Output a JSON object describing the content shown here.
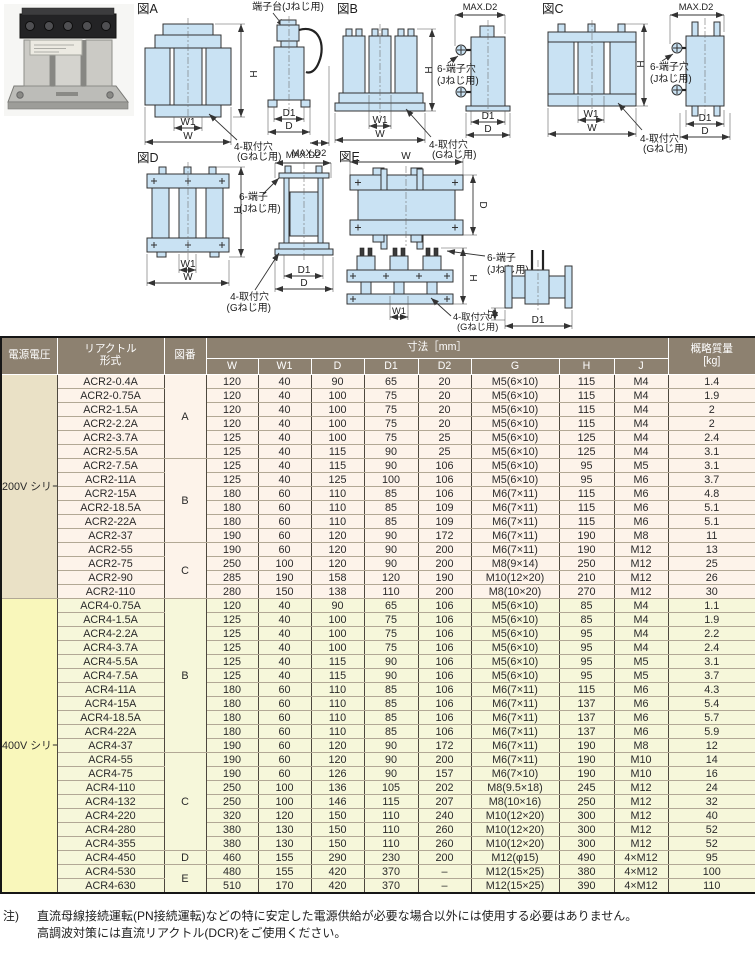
{
  "colors": {
    "header_bg": "#8d8170",
    "header_text": "#ffffff",
    "v200_label_bg": "#eae1c6",
    "v200_row_bg": "#fdf3ea",
    "v400_label_bg": "#f9f7bb",
    "v400_row_bg": "#f6f7da",
    "h_border": "#b2a895",
    "v_border": "#4e483f",
    "diagram_fill": "#c9e2f3",
    "diagram_stroke": "#333333"
  },
  "figures": {
    "figA": {
      "title": "図A",
      "terminal": "端子台(Jねじ用)",
      "mount1": "4-取付穴",
      "mount2": "(Gねじ用)",
      "h": "H",
      "w1": "W1",
      "w": "W",
      "d1": "D1",
      "d": "D",
      "d2": "MAX.D2"
    },
    "figB": {
      "title": "図B",
      "term1": "6-端子穴",
      "term2": "(Jねじ用)",
      "mount1": "4-取付穴",
      "mount2": "(Gねじ用)",
      "h": "H",
      "w1": "W1",
      "w": "W",
      "d1": "D1",
      "d": "D",
      "d2": "MAX.D2"
    },
    "figC": {
      "title": "図C",
      "term1": "6-端子穴",
      "term2": "(Jねじ用)",
      "mount1": "4-取付穴",
      "mount2": "(Gねじ用)",
      "h": "H",
      "w1": "W1",
      "w": "W",
      "d1": "D1",
      "d": "D",
      "d2": "MAX.D2"
    },
    "figD": {
      "title": "図D",
      "term1": "6-端子",
      "term2": "(Jねじ用)",
      "mount1": "4-取付穴",
      "mount2": "(Gねじ用)",
      "h": "H",
      "w1": "W1",
      "w": "W",
      "d1": "D1",
      "d": "D",
      "d2": "MAX.D2"
    },
    "figE": {
      "title": "図E",
      "term1": "6-端子",
      "term2": "(Jねじ用)",
      "mount1": "4-取付穴",
      "mount2": "(Gねじ用)",
      "w": "W",
      "d": "D",
      "h": "H",
      "w1": "W1",
      "d1": "D1",
      "base": "15"
    }
  },
  "table": {
    "headers": {
      "voltage": "電源電圧",
      "model": "リアクトル\n形式",
      "fig": "図番",
      "dims": "寸法［mm］",
      "w": "W",
      "w1": "W1",
      "d": "D",
      "d1": "D1",
      "d2": "D2",
      "g": "G",
      "h": "H",
      "j": "J",
      "weight": "概略質量\n[kg]"
    },
    "sections": [
      {
        "series": "200V\nシリーズ",
        "css": "v200",
        "groups": [
          {
            "fig": "A",
            "rows": [
              [
                "ACR2-0.4A",
                "120",
                "40",
                "90",
                "65",
                "20",
                "M5(6×10)",
                "115",
                "M4",
                "1.4"
              ],
              [
                "ACR2-0.75A",
                "120",
                "40",
                "100",
                "75",
                "20",
                "M5(6×10)",
                "115",
                "M4",
                "1.9"
              ],
              [
                "ACR2-1.5A",
                "120",
                "40",
                "100",
                "75",
                "20",
                "M5(6×10)",
                "115",
                "M4",
                "2"
              ],
              [
                "ACR2-2.2A",
                "120",
                "40",
                "100",
                "75",
                "20",
                "M5(6×10)",
                "115",
                "M4",
                "2"
              ],
              [
                "ACR2-3.7A",
                "125",
                "40",
                "100",
                "75",
                "25",
                "M5(6×10)",
                "125",
                "M4",
                "2.4"
              ],
              [
                "ACR2-5.5A",
                "125",
                "40",
                "115",
                "90",
                "25",
                "M5(6×10)",
                "125",
                "M4",
                "3.1"
              ]
            ]
          },
          {
            "fig": "B",
            "rows": [
              [
                "ACR2-7.5A",
                "125",
                "40",
                "115",
                "90",
                "106",
                "M5(6×10)",
                "95",
                "M5",
                "3.1"
              ],
              [
                "ACR2-11A",
                "125",
                "40",
                "125",
                "100",
                "106",
                "M5(6×10)",
                "95",
                "M6",
                "3.7"
              ],
              [
                "ACR2-15A",
                "180",
                "60",
                "110",
                "85",
                "106",
                "M6(7×11)",
                "115",
                "M6",
                "4.8"
              ],
              [
                "ACR2-18.5A",
                "180",
                "60",
                "110",
                "85",
                "109",
                "M6(7×11)",
                "115",
                "M6",
                "5.1"
              ],
              [
                "ACR2-22A",
                "180",
                "60",
                "110",
                "85",
                "109",
                "M6(7×11)",
                "115",
                "M6",
                "5.1"
              ],
              [
                "ACR2-37",
                "190",
                "60",
                "120",
                "90",
                "172",
                "M6(7×11)",
                "190",
                "M8",
                "11"
              ]
            ]
          },
          {
            "fig": "C",
            "rows": [
              [
                "ACR2-55",
                "190",
                "60",
                "120",
                "90",
                "200",
                "M6(7×11)",
                "190",
                "M12",
                "13"
              ],
              [
                "ACR2-75",
                "250",
                "100",
                "120",
                "90",
                "200",
                "M8(9×14)",
                "250",
                "M12",
                "25"
              ],
              [
                "ACR2-90",
                "285",
                "190",
                "158",
                "120",
                "190",
                "M10(12×20)",
                "210",
                "M12",
                "26"
              ],
              [
                "ACR2-110",
                "280",
                "150",
                "138",
                "110",
                "200",
                "M8(10×20)",
                "270",
                "M12",
                "30"
              ]
            ]
          }
        ]
      },
      {
        "series": "400V\nシリーズ",
        "css": "v400",
        "groups": [
          {
            "fig": "B",
            "rows": [
              [
                "ACR4-0.75A",
                "120",
                "40",
                "90",
                "65",
                "106",
                "M5(6×10)",
                "85",
                "M4",
                "1.1"
              ],
              [
                "ACR4-1.5A",
                "125",
                "40",
                "100",
                "75",
                "106",
                "M5(6×10)",
                "85",
                "M4",
                "1.9"
              ],
              [
                "ACR4-2.2A",
                "125",
                "40",
                "100",
                "75",
                "106",
                "M5(6×10)",
                "95",
                "M4",
                "2.2"
              ],
              [
                "ACR4-3.7A",
                "125",
                "40",
                "100",
                "75",
                "106",
                "M5(6×10)",
                "95",
                "M4",
                "2.4"
              ],
              [
                "ACR4-5.5A",
                "125",
                "40",
                "115",
                "90",
                "106",
                "M5(6×10)",
                "95",
                "M5",
                "3.1"
              ],
              [
                "ACR4-7.5A",
                "125",
                "40",
                "115",
                "90",
                "106",
                "M5(6×10)",
                "95",
                "M5",
                "3.7"
              ],
              [
                "ACR4-11A",
                "180",
                "60",
                "110",
                "85",
                "106",
                "M6(7×11)",
                "115",
                "M6",
                "4.3"
              ],
              [
                "ACR4-15A",
                "180",
                "60",
                "110",
                "85",
                "106",
                "M6(7×11)",
                "137",
                "M6",
                "5.4"
              ],
              [
                "ACR4-18.5A",
                "180",
                "60",
                "110",
                "85",
                "106",
                "M6(7×11)",
                "137",
                "M6",
                "5.7"
              ],
              [
                "ACR4-22A",
                "180",
                "60",
                "110",
                "85",
                "106",
                "M6(7×11)",
                "137",
                "M6",
                "5.9"
              ],
              [
                "ACR4-37",
                "190",
                "60",
                "120",
                "90",
                "172",
                "M6(7×11)",
                "190",
                "M8",
                "12"
              ]
            ]
          },
          {
            "fig": "C",
            "rows": [
              [
                "ACR4-55",
                "190",
                "60",
                "120",
                "90",
                "200",
                "M6(7×11)",
                "190",
                "M10",
                "14"
              ],
              [
                "ACR4-75",
                "190",
                "60",
                "126",
                "90",
                "157",
                "M6(7×10)",
                "190",
                "M10",
                "16"
              ],
              [
                "ACR4-110",
                "250",
                "100",
                "136",
                "105",
                "202",
                "M8(9.5×18)",
                "245",
                "M12",
                "24"
              ],
              [
                "ACR4-132",
                "250",
                "100",
                "146",
                "115",
                "207",
                "M8(10×16)",
                "250",
                "M12",
                "32"
              ],
              [
                "ACR4-220",
                "320",
                "120",
                "150",
                "110",
                "240",
                "M10(12×20)",
                "300",
                "M12",
                "40"
              ],
              [
                "ACR4-280",
                "380",
                "130",
                "150",
                "110",
                "260",
                "M10(12×20)",
                "300",
                "M12",
                "52"
              ],
              [
                "ACR4-355",
                "380",
                "130",
                "150",
                "110",
                "260",
                "M10(12×20)",
                "300",
                "M12",
                "52"
              ]
            ]
          },
          {
            "fig": "D",
            "rows": [
              [
                "ACR4-450",
                "460",
                "155",
                "290",
                "230",
                "200",
                "M12(φ15)",
                "490",
                "4×M12",
                "95"
              ]
            ]
          },
          {
            "fig": "E",
            "rows": [
              [
                "ACR4-530",
                "480",
                "155",
                "420",
                "370",
                "–",
                "M12(15×25)",
                "380",
                "4×M12",
                "100"
              ],
              [
                "ACR4-630",
                "510",
                "170",
                "420",
                "370",
                "–",
                "M12(15×25)",
                "390",
                "4×M12",
                "110"
              ]
            ]
          }
        ]
      }
    ]
  },
  "notes": {
    "label": "注)",
    "line1": "直流母線接続運転(PN接続運転)などの特に安定した電源供給が必要な場合以外には使用する必要はありません。",
    "line2": "高調波対策には直流リアクトル(DCR)をご使用ください。"
  }
}
